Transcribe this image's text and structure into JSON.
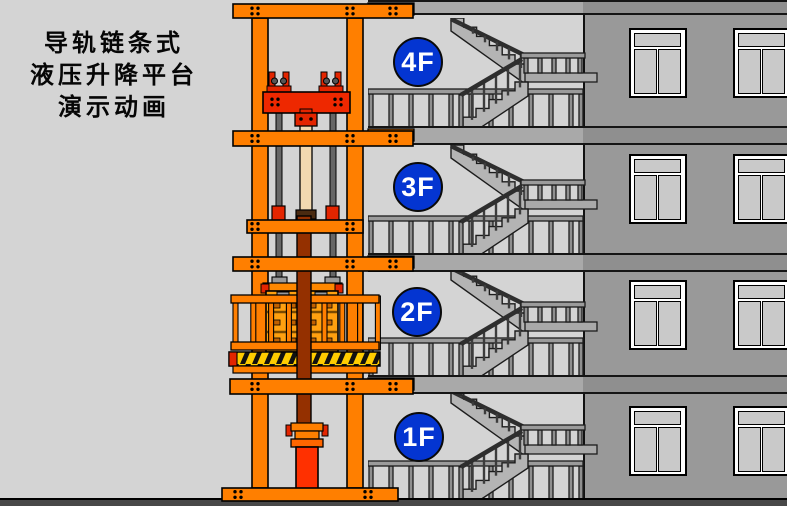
{
  "title": {
    "lines": [
      "导轨链条式",
      "液压升降平台",
      "演示动画"
    ]
  },
  "floor_labels": [
    {
      "id": "4F",
      "label": "4F",
      "cx": 418,
      "cy": 62,
      "slab_top": 126
    },
    {
      "id": "3F",
      "label": "3F",
      "cx": 418,
      "cy": 187,
      "slab_top": 253
    },
    {
      "id": "2F",
      "label": "2F",
      "cx": 417,
      "cy": 312,
      "slab_top": 375
    },
    {
      "id": "1F",
      "label": "1F",
      "cx": 419,
      "cy": 437,
      "slab_top": 498
    }
  ],
  "building": {
    "wall_x": 583,
    "slab_bands": [
      {
        "y": 0,
        "h": 15
      },
      {
        "y": 126,
        "h": 19
      },
      {
        "y": 253,
        "h": 19
      },
      {
        "y": 375,
        "h": 19
      }
    ],
    "window_rows": [
      28,
      154,
      280,
      406
    ],
    "window_cols": [
      629,
      733
    ],
    "window_width": 58,
    "window_height": 70,
    "ground_y": 498
  },
  "colors": {
    "background": "#D4D4D4",
    "wall": "#999999",
    "wall_band": "#8F8F8F",
    "slab": "#A9A9A9",
    "ground": "#484848",
    "structure_orange": "#FF7F00",
    "carriage_red": "#E32500",
    "cylinder_red": "#FF3000",
    "cylinder_brown": "#943000",
    "piston_cream": "#F2D9B0",
    "chain_gray": "#666666",
    "cargo_orange": "#FFA010",
    "hazard_yellow": "#FFCC00",
    "hazard_black": "#111111",
    "label_blue": "#0435D1",
    "label_text": "#FFFFFF",
    "window_glass": "#C9C9C9",
    "window_frame": "#FFFFFF",
    "railing_gray": "#9B9B9B",
    "stair_gray": "#B4B4B4",
    "title_text": "#060606"
  },
  "scene": {
    "width": 787,
    "height": 506
  }
}
